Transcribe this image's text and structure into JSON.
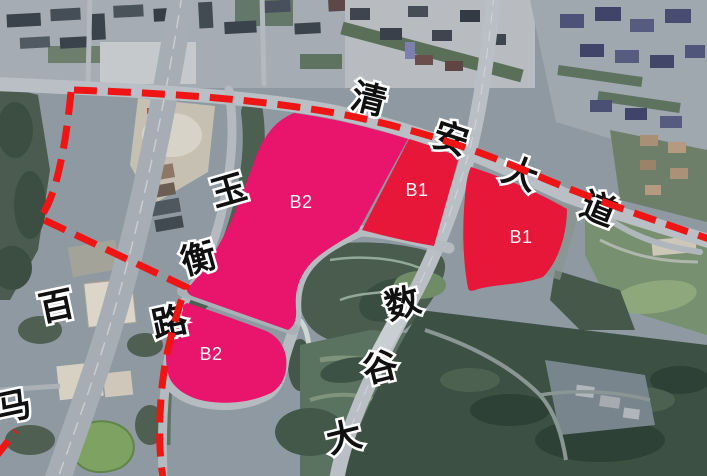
{
  "map": {
    "description": "Satellite imagery with land-use planning overlay",
    "zones": [
      {
        "id": "b2-north",
        "label": "B2",
        "type": "B2",
        "color": "#E9146B"
      },
      {
        "id": "b1-west",
        "label": "B1",
        "type": "B1",
        "color": "#E61738"
      },
      {
        "id": "b1-east",
        "label": "B1",
        "type": "B1",
        "color": "#E61738"
      },
      {
        "id": "b2-south",
        "label": "B2",
        "type": "B2",
        "color": "#E9146B"
      }
    ],
    "road_labels": [
      {
        "id": "qingan-avenue",
        "name": "清安大道",
        "chars": [
          "清",
          "安",
          "大",
          "道"
        ]
      },
      {
        "id": "yuheng-road",
        "name": "玉衡路",
        "chars": [
          "玉",
          "衡",
          "路"
        ]
      },
      {
        "id": "shugu-avenue",
        "name": "数谷大",
        "chars": [
          "数",
          "谷",
          "大"
        ]
      },
      {
        "id": "baima-road",
        "name": "百马",
        "chars": [
          "百",
          "马"
        ]
      }
    ],
    "boundary": {
      "id": "planning-boundary",
      "style": "red-dashed",
      "color": "#EE1514"
    }
  }
}
